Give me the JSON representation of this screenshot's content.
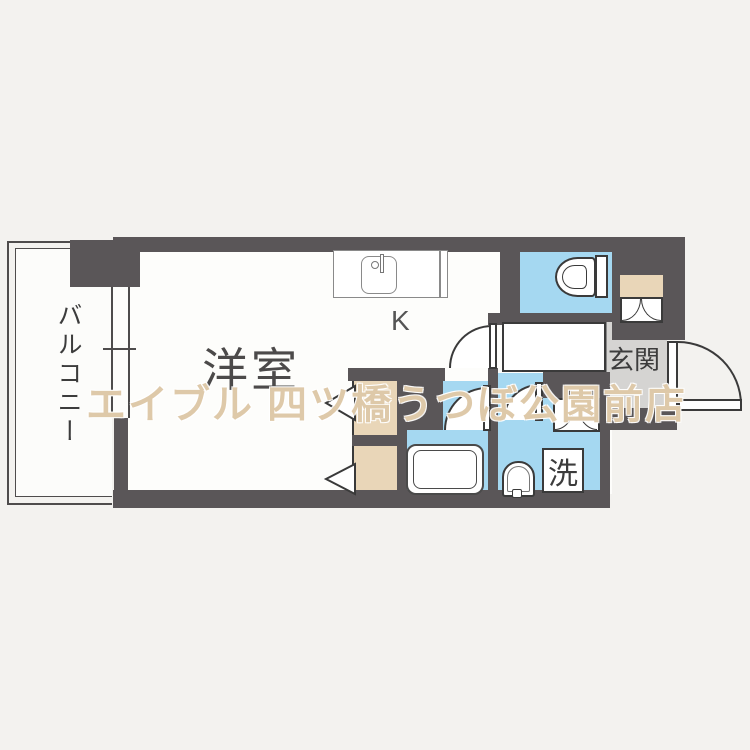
{
  "plan": {
    "type": "apartment-floor-plan",
    "labels": {
      "balcony": "バルコニー",
      "main_room": "洋室",
      "kitchen": "K",
      "entrance": "玄関",
      "laundry": "洗"
    },
    "watermark": "エイブル 四ツ橋うつぼ公園前店",
    "colors": {
      "wall": "#5a5658",
      "wet_area": "#a5d8f1",
      "closet": "#e9d6b8",
      "entrance_floor": "#d5d4d2",
      "floor": "#fdfdfb",
      "background": "#f3f2ef"
    }
  }
}
